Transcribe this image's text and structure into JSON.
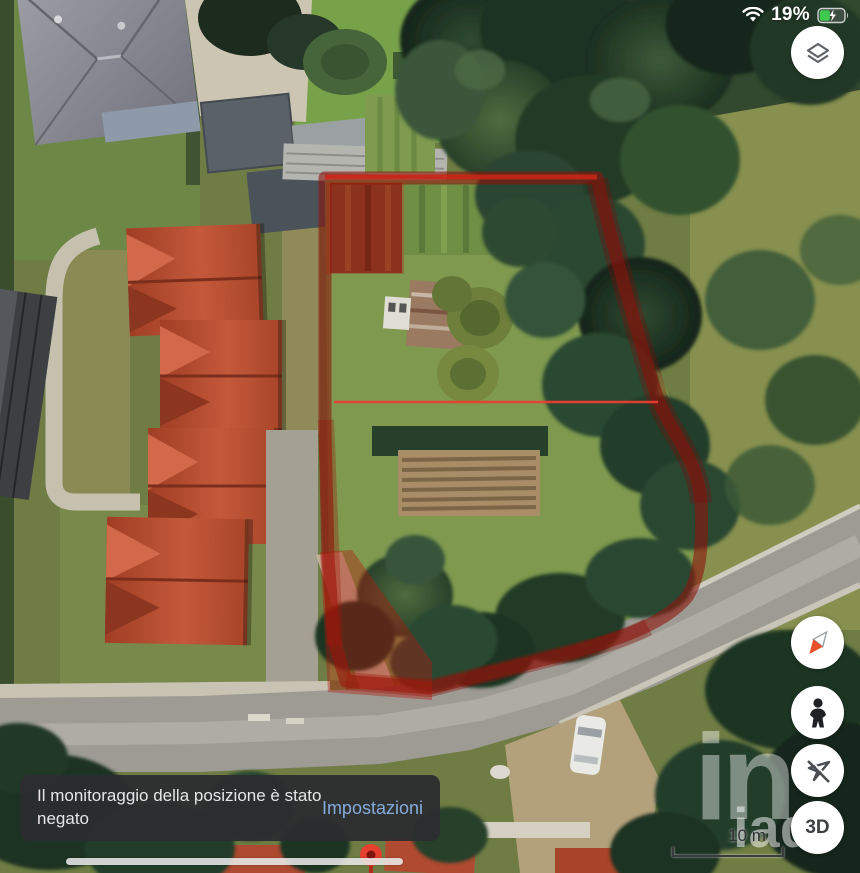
{
  "status_bar": {
    "battery_percent": "19%",
    "icons": [
      "wifi-icon",
      "battery-charging-icon"
    ],
    "battery_level_fraction": 0.4,
    "battery_fill_color": "#3ec94f"
  },
  "map_overlay": {
    "boundary_color": "#8c160c",
    "measure_line_color": "#e63b2d",
    "pin_color": "#e94335"
  },
  "controls": {
    "layers_icon": "map-layers",
    "compass_icon": "compass-needle",
    "pegman_icon": "street-view-pegman",
    "location_icon": "location-disabled",
    "threed_label": "3D"
  },
  "scale_bar": {
    "label": "10 m"
  },
  "watermark": {
    "large": "in",
    "small": "iad"
  },
  "toast": {
    "message": "Il monitoraggio della posizione è stato negato",
    "action": "Impostazioni"
  }
}
